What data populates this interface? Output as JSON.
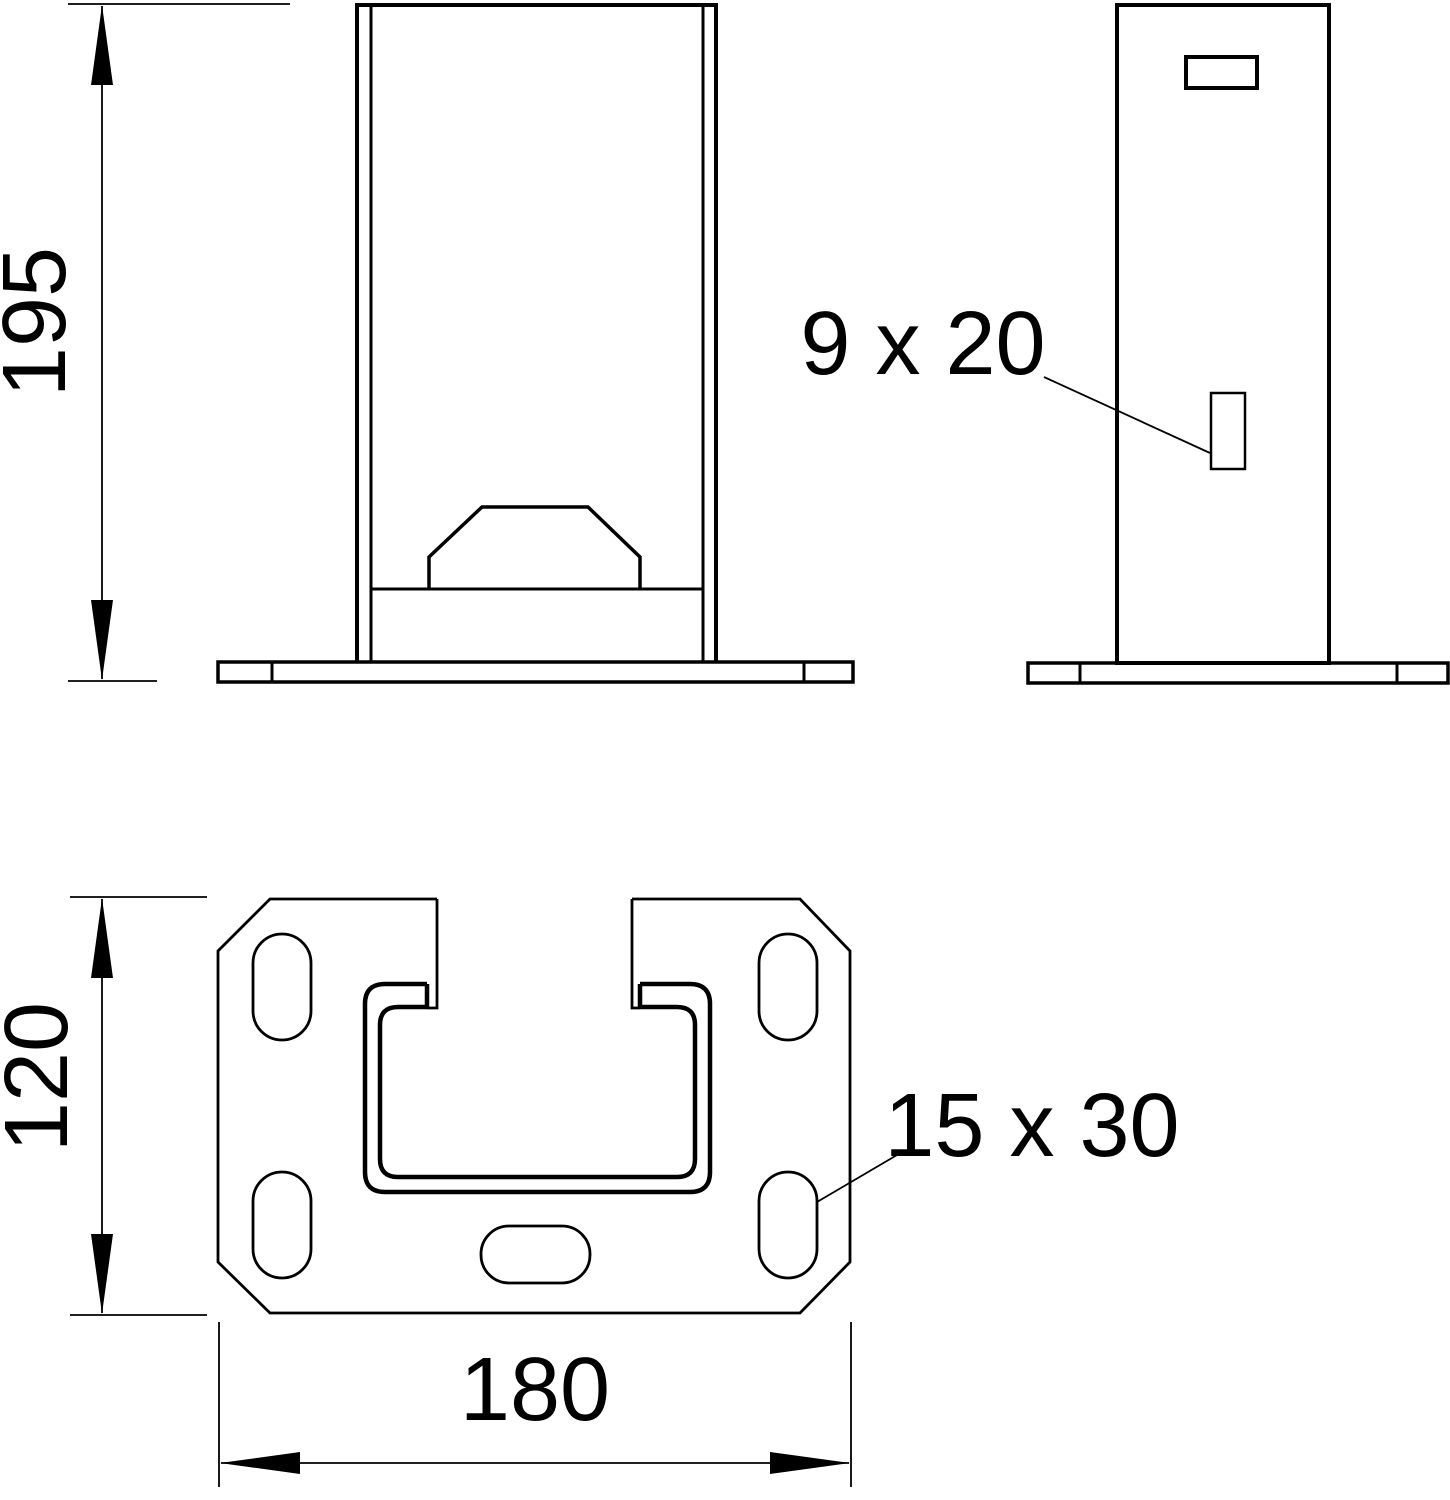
{
  "drawing": {
    "dimensions": {
      "upright_height": "195",
      "plate_depth": "120",
      "plate_width": "180"
    },
    "labels": {
      "upright_slot": "9 x 20",
      "plate_slot": "15 x 30"
    },
    "colors": {
      "line": "#000000",
      "background": "#ffffff"
    }
  }
}
